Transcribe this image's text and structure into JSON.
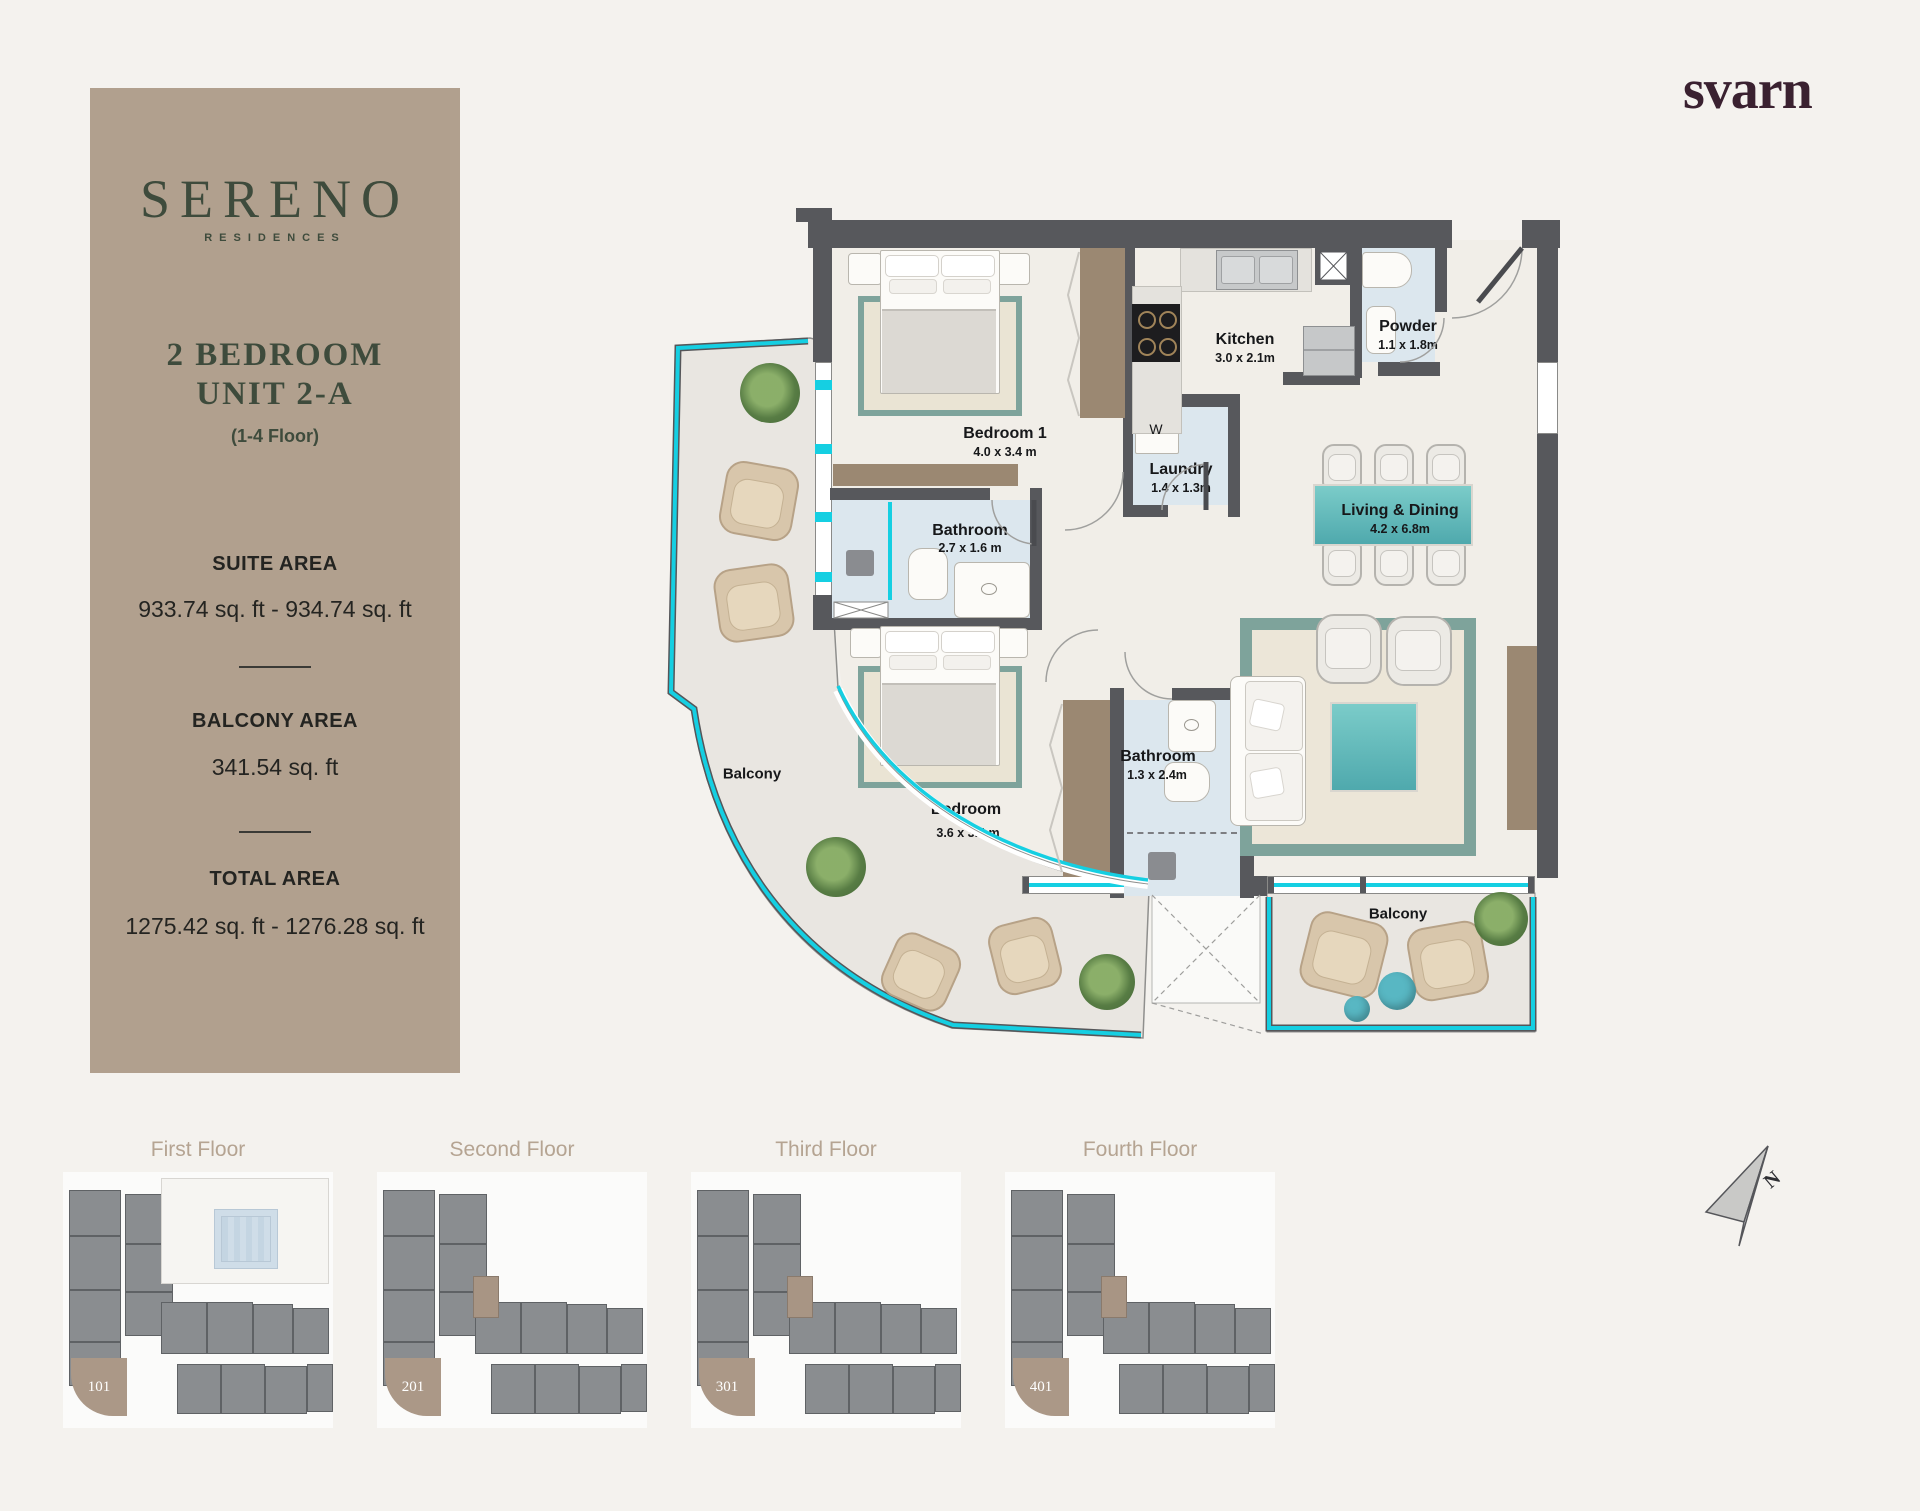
{
  "brand_panel": {
    "logo": "SERENO",
    "logo_sub": "RESIDENCES",
    "unit_title_line1": "2 BEDROOM",
    "unit_title_line2": "UNIT 2-A",
    "floors_note": "(1-4 Floor)",
    "sections": [
      {
        "label": "SUITE AREA",
        "value": "933.74 sq. ft - 934.74 sq. ft"
      },
      {
        "label": "BALCONY AREA",
        "value": "341.54 sq. ft"
      },
      {
        "label": "TOTAL AREA",
        "value": "1275.42 sq. ft - 1276.28 sq. ft"
      }
    ]
  },
  "developer_logo": "svarn",
  "floor_plan": {
    "washer_label": "W",
    "rooms": [
      {
        "name": "Bedroom 1",
        "dims": "4.0 x 3.4 m"
      },
      {
        "name": "Bathroom",
        "dims": "2.7 x 1.6 m"
      },
      {
        "name": "Bedroom",
        "dims": "3.6 x 3.4 m"
      },
      {
        "name": "Bathroom",
        "dims": "1.3 x 2.4m"
      },
      {
        "name": "Kitchen",
        "dims": "3.0 x 2.1m"
      },
      {
        "name": "Laundry",
        "dims": "1.4 x 1.3m"
      },
      {
        "name": "Powder",
        "dims": "1.1 x 1.8m"
      },
      {
        "name": "Living & Dining",
        "dims": "4.2 x 6.8m"
      },
      {
        "name": "Balcony",
        "dims": ""
      },
      {
        "name": "Balcony",
        "dims": ""
      }
    ]
  },
  "floor_thumbnails": [
    {
      "label": "First Floor",
      "unit": "101"
    },
    {
      "label": "Second Floor",
      "unit": "201"
    },
    {
      "label": "Third Floor",
      "unit": "301"
    },
    {
      "label": "Fourth Floor",
      "unit": "401"
    }
  ],
  "compass": {
    "label": "N"
  },
  "colors": {
    "panel_tan": "#b1a08e",
    "logo_green": "#3e4b3c",
    "developer_plum": "#3a2130",
    "wall_gray": "#57585c",
    "rail_cyan": "#15cfe2",
    "accent_teal": "#5cb9c5",
    "highlight_unit_tan": "#ab9887"
  }
}
